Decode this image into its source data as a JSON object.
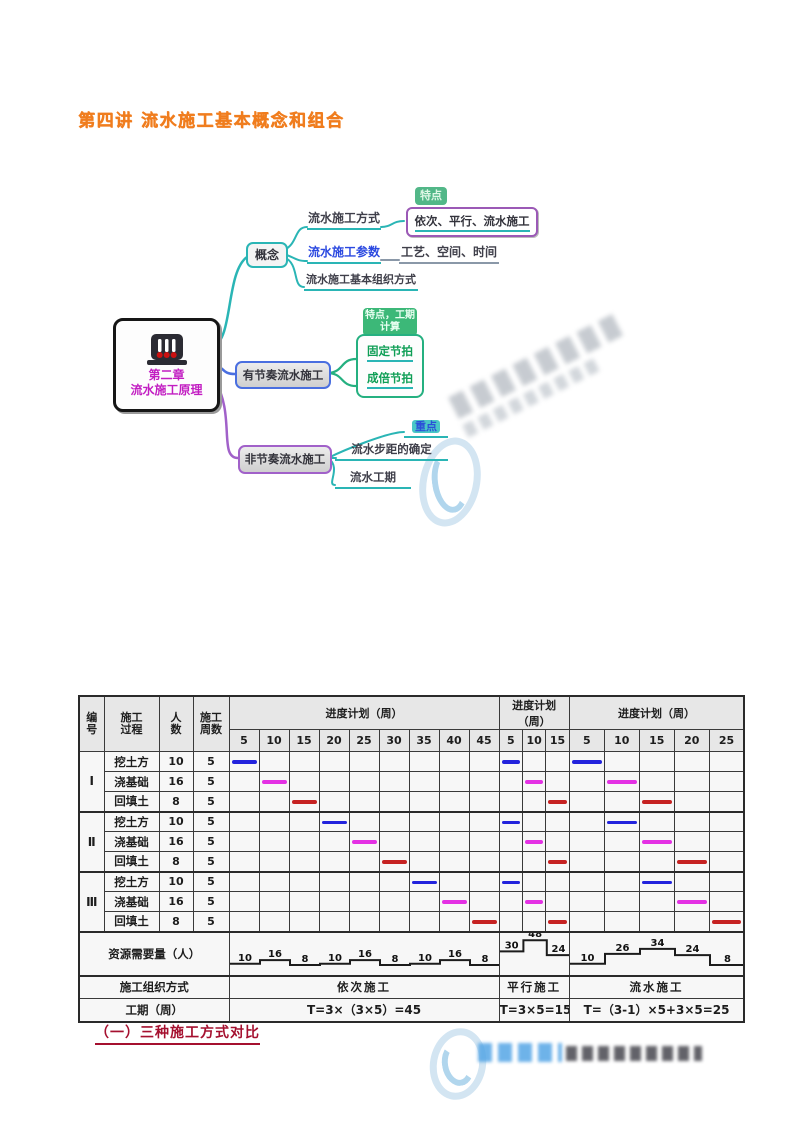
{
  "page": {
    "title": "第四讲 流水施工基本概念和组合",
    "caption": "（一）三种施工方式对比"
  },
  "mindmap": {
    "root": {
      "chapter": "第二章",
      "title": "流水施工原理",
      "icon": "faucet-drip-icon"
    },
    "concept": {
      "label": "概念",
      "items": [
        {
          "label": "流水施工方式",
          "tag": "特点",
          "value": "依次、平行、流水施工"
        },
        {
          "label": "流水施工参数",
          "value": "工艺、空间、时间"
        },
        {
          "label": "流水施工基本组织方式"
        }
      ]
    },
    "rhythmic": {
      "label": "有节奏流水施工",
      "tag": "特点，工期计算",
      "items": [
        "固定节拍",
        "成倍节拍"
      ]
    },
    "non_rhythmic": {
      "label": "非节奏流水施工",
      "tag": "重点",
      "items": [
        "流水步距的确定",
        "流水工期"
      ]
    }
  },
  "chart_data": {
    "type": "gantt",
    "time_unit_label": "周",
    "weeks_per_column": 5,
    "header": {
      "id": "编\n号",
      "process": "施工\n过程",
      "workers": "人\n数",
      "weeks": "施工\n周数",
      "schedule": "进度计划（周）"
    },
    "sections": [
      {
        "name": "依次施工",
        "ticks": [
          5,
          10,
          15,
          20,
          25,
          30,
          35,
          40,
          45
        ],
        "duration_formula": "T=3×（3×5）=45",
        "total_weeks": 45,
        "resource_profile": [
          10,
          16,
          8,
          10,
          16,
          8,
          10,
          16,
          8
        ]
      },
      {
        "name": "平行施工",
        "ticks": [
          5,
          10,
          15
        ],
        "duration_formula": "T=3×5=15",
        "total_weeks": 15,
        "resource_profile": [
          30,
          48,
          24
        ]
      },
      {
        "name": "流水施工",
        "ticks": [
          5,
          10,
          15,
          20,
          25
        ],
        "duration_formula": "T=（3-1）×5+3×5=25",
        "total_weeks": 25,
        "resource_profile": [
          10,
          26,
          34,
          24,
          8
        ]
      }
    ],
    "rows": [
      {
        "group": "Ⅰ",
        "process": "挖土方",
        "workers": 10,
        "weeks": 5,
        "color": "#2323dd",
        "bar_col": [
          1,
          1,
          1
        ]
      },
      {
        "group": "",
        "process": "浇基础",
        "workers": 16,
        "weeks": 5,
        "color": "#e431e4",
        "bar_col": [
          2,
          2,
          2
        ]
      },
      {
        "group": "",
        "process": "回填土",
        "workers": 8,
        "weeks": 5,
        "color": "#c62222",
        "bar_col": [
          3,
          3,
          3
        ]
      },
      {
        "group": "Ⅱ",
        "process": "挖土方",
        "workers": 10,
        "weeks": 5,
        "color": "#2323dd",
        "bar_col": [
          4,
          1,
          2
        ]
      },
      {
        "group": "",
        "process": "浇基础",
        "workers": 16,
        "weeks": 5,
        "color": "#e431e4",
        "bar_col": [
          5,
          2,
          3
        ]
      },
      {
        "group": "",
        "process": "回填土",
        "workers": 8,
        "weeks": 5,
        "color": "#c62222",
        "bar_col": [
          6,
          3,
          4
        ]
      },
      {
        "group": "Ⅲ",
        "process": "挖土方",
        "workers": 10,
        "weeks": 5,
        "color": "#2323dd",
        "bar_col": [
          7,
          1,
          3
        ]
      },
      {
        "group": "",
        "process": "浇基础",
        "workers": 16,
        "weeks": 5,
        "color": "#e431e4",
        "bar_col": [
          8,
          2,
          4
        ]
      },
      {
        "group": "",
        "process": "回填土",
        "workers": 8,
        "weeks": 5,
        "color": "#c62222",
        "bar_col": [
          9,
          3,
          5
        ]
      }
    ],
    "footer": {
      "resource_label": "资源需要量（人）",
      "method_label": "施工组织方式",
      "duration_label": "工期（周）"
    }
  },
  "colors": {
    "title": "#f07d1e",
    "caption": "#a5102f",
    "teal": "#2ab5b5",
    "blue": "#4a6fe0",
    "purple": "#a161c9",
    "green": "#25b080",
    "root_text": "#c21ec2",
    "bar_blue": "#2323dd",
    "bar_magenta": "#e431e4",
    "bar_red": "#c62222"
  },
  "watermark": {
    "logo": "swoosh-ellipse-logo"
  }
}
